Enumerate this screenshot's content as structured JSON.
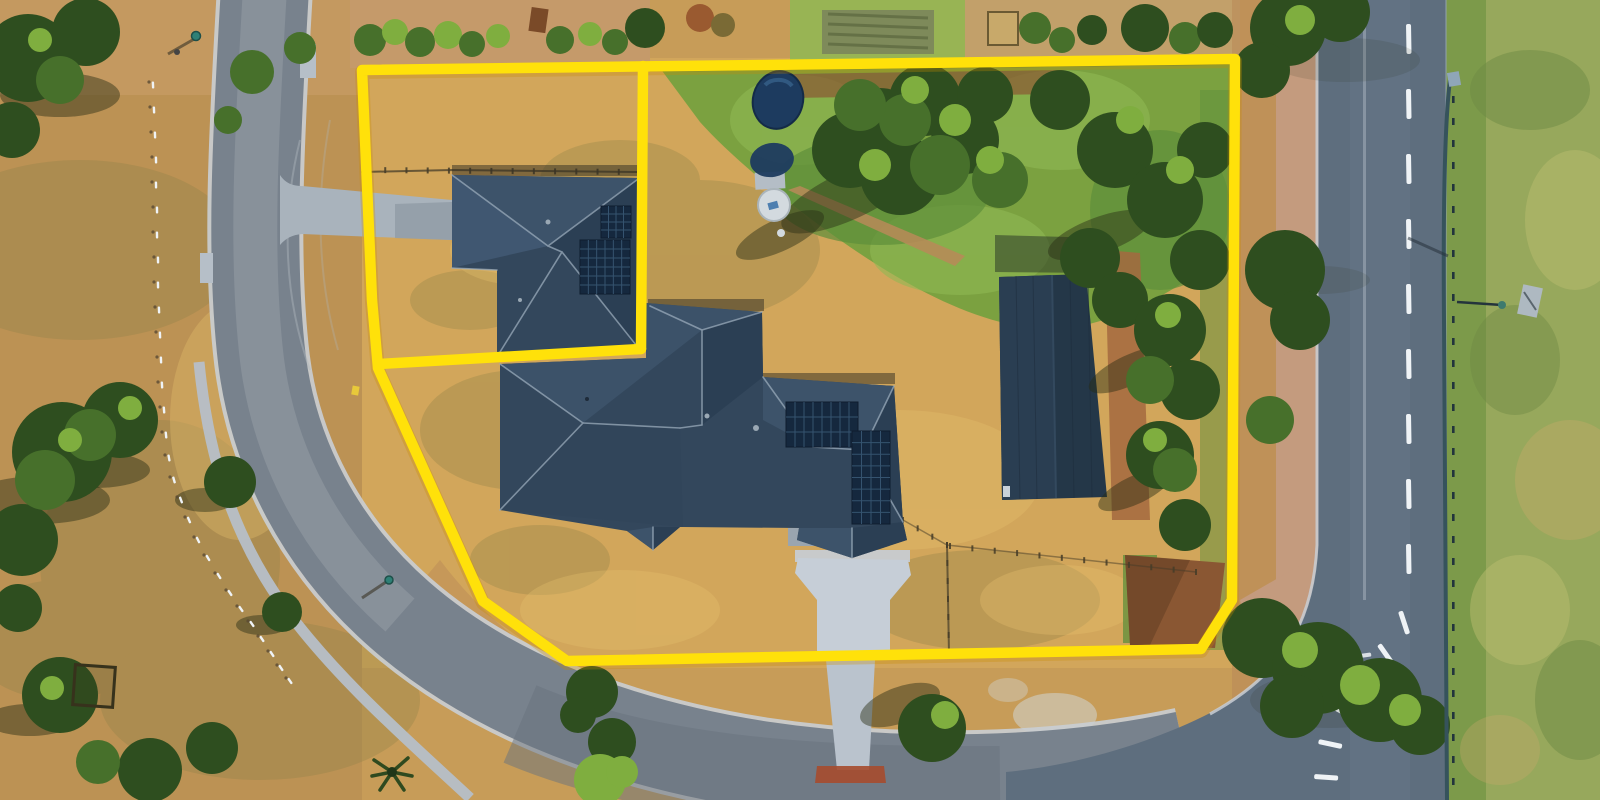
{
  "meta": {
    "title": "Aerial drone photograph of acreage property with highlighted lot boundary",
    "kind": "photograph",
    "visible_text": "none"
  },
  "palette": {
    "dry1": "#C79C58",
    "dry2": "#D5A95C",
    "dryLeft": "#BC9254",
    "olive": "#8D8148",
    "lightpatch": "#E6C06E",
    "green1": "#76A03F",
    "green2": "#5E8F3B",
    "green3": "#8FB954",
    "verge": "#7C9A4A",
    "treeDark": "#2E4E1F",
    "tree": "#47702B",
    "treeLight": "#7FAE3F",
    "roadL": "#78828D",
    "roadLLight": "#97A0A8",
    "roadLDark": "#68727D",
    "roadR": "#5E6E7E",
    "kerb": "#C9CED4",
    "path": "#B6BFC8",
    "drive": "#C6CED7",
    "driveSide": "#A0AAB4",
    "roof1": "#33475C",
    "roof2": "#3D536A",
    "roof3": "#2B3F54",
    "ridge": "#9AABBB",
    "solar": "#15283E",
    "solarGrid": "#35536F",
    "shed1": "#243748",
    "shed2": "#2A3E52",
    "dirt": "#B98A58",
    "dirtRed": "#A4693F",
    "dirtDark": "#8A5733",
    "gravel": "#C49B7E",
    "pool": "#1D3B5F",
    "poolHi": "#3A6690",
    "white": "#EFF3F6",
    "yellow": "#FFE10A",
    "yellowGlow": "#C98A00",
    "shadow": "rgba(40,45,20,0.45)",
    "fence": "#453C28",
    "rail": "#36535C",
    "railDark": "#22343C",
    "pasture": "#97A85C",
    "pastureDark": "#6E8A44",
    "pastureLight": "#B9BC6E"
  },
  "boundary": {
    "color": "#FFE10A",
    "stroke_width": 10.5,
    "outer": [
      [
        362,
        70
      ],
      [
        372,
        300
      ],
      [
        378,
        368
      ],
      [
        483,
        601
      ],
      [
        567,
        661
      ],
      [
        1201,
        649
      ],
      [
        1232,
        600
      ],
      [
        1235,
        59
      ]
    ],
    "divider_h": [
      [
        378,
        364
      ],
      [
        641,
        349
      ]
    ],
    "divider_v": [
      [
        641,
        349
      ],
      [
        643,
        66
      ]
    ]
  },
  "generators": {
    "bollards": {
      "points": [
        [
          153,
          85
        ],
        [
          154,
          110
        ],
        [
          155,
          135
        ],
        [
          156,
          160
        ],
        [
          156,
          185
        ],
        [
          157,
          210
        ],
        [
          157,
          235
        ],
        [
          158,
          260
        ],
        [
          158,
          285
        ],
        [
          159,
          310
        ],
        [
          160,
          335
        ],
        [
          161,
          360
        ],
        [
          162,
          385
        ],
        [
          164,
          410
        ],
        [
          166,
          435
        ],
        [
          169,
          458
        ],
        [
          174,
          480
        ],
        [
          181,
          500
        ],
        [
          189,
          520
        ],
        [
          198,
          540
        ],
        [
          208,
          558
        ],
        [
          219,
          576
        ],
        [
          230,
          593
        ],
        [
          241,
          609
        ],
        [
          252,
          624
        ],
        [
          262,
          639
        ],
        [
          272,
          654
        ],
        [
          281,
          668
        ],
        [
          290,
          681
        ]
      ]
    },
    "laneDashes": {
      "x": 1406,
      "y0": 24,
      "count": 9,
      "step": 65,
      "w": 5,
      "h": 30
    },
    "curveDashes": [
      [
        1398,
        612,
        -18
      ],
      [
        1377,
        646,
        -35
      ],
      [
        1351,
        676,
        -48
      ],
      [
        1330,
        708,
        -62
      ],
      [
        1318,
        744,
        -78
      ],
      [
        1314,
        779,
        -86
      ]
    ],
    "givewayDashes": {
      "x0": 1292,
      "y": 654,
      "count": 5,
      "step": 17,
      "w": 11,
      "h": 4
    },
    "railPosts": {
      "x": 1452,
      "y0": 96,
      "y1": 796,
      "step": 22
    },
    "fences": [
      {
        "from": [
          572,
          659
        ],
        "to": [
          1198,
          650
        ],
        "count": 26
      },
      {
        "from": [
          364,
          170
        ],
        "to": [
          640,
          172
        ],
        "count": 13
      },
      {
        "from": [
          947,
          545
        ],
        "to": [
          949,
          653
        ],
        "count": 6
      },
      {
        "from": [
          903,
          520
        ],
        "to": [
          947,
          545
        ],
        "count": 3
      },
      {
        "from": [
          950,
          546
        ],
        "to": [
          1196,
          572
        ],
        "count": 11
      }
    ],
    "solarArrays": [
      [
        601,
        206,
        30,
        32,
        4,
        4
      ],
      [
        580,
        240,
        50,
        54,
        6,
        6
      ],
      [
        786,
        402,
        72,
        45,
        8,
        3
      ],
      [
        852,
        431,
        38,
        93,
        4,
        8
      ]
    ]
  },
  "objects": {
    "buildings": [
      "upper-left-house",
      "main-house",
      "farm-shed"
    ],
    "landmarks": [
      "swimming-pool",
      "water-tank",
      "picnic-enclosure",
      "palm-tree",
      "guard-rail",
      "street-lamps",
      "bollard-row"
    ],
    "roads": [
      "curved-street-west",
      "main-road-east",
      "intersection-south-east"
    ],
    "overlay": "yellow-lot-boundary-with-internal-divider"
  }
}
